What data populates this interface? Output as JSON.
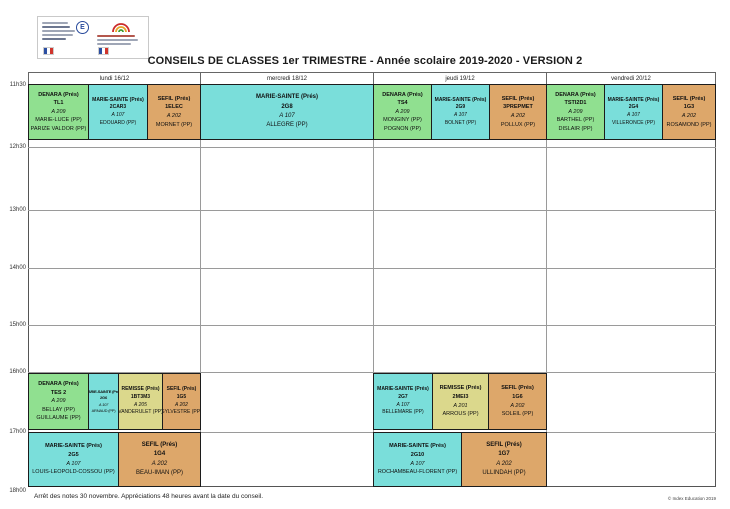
{
  "header": {
    "title": "CONSEILS DE CLASSES 1er TRIMESTRE - Année scolaire 2019-2020 - VERSION 2",
    "logos": {
      "emblem_letter": "E",
      "ministry_logo": "ministry-logo",
      "school_logo": "school-crest-logo",
      "flag": "french-flag-icon"
    }
  },
  "days": [
    "lundi 16/12",
    "mercredi 18/12",
    "jeudi 19/12",
    "vendredi 20/12"
  ],
  "times": [
    "11h30",
    "12h30",
    "13h00",
    "14h00",
    "15h00",
    "16h00",
    "17h00",
    "18h00"
  ],
  "legend_colors": {
    "DENARA": "#90e090",
    "MARIE-SAINTE": "#7adeda",
    "SEFIL": "#dda76a",
    "REMISSE": "#dbd88c"
  },
  "cells": [
    {
      "pres": "DENARA (Prés)",
      "cls": "TL1",
      "room": "A 209",
      "pps": [
        "MARIE-LUCE (PP)",
        "PARIZE VALDOR (PP)"
      ]
    },
    {
      "pres": "MARIE-SAINTE (Prés)",
      "cls": "2CAR3",
      "room": "A 107",
      "pps": [
        "EDOUARD (PP)"
      ]
    },
    {
      "pres": "SEFIL (Prés)",
      "cls": "1ELEC",
      "room": "A 202",
      "pps": [
        "MORNET (PP)"
      ]
    },
    {
      "pres": "MARIE-SAINTE (Prés)",
      "cls": "2G8",
      "room": "A 107",
      "pps": [
        "ALLEGRE (PP)"
      ]
    },
    {
      "pres": "DENARA (Prés)",
      "cls": "TS4",
      "room": "A 209",
      "pps": [
        "MONGINY (PP)",
        "POGNON (PP)"
      ]
    },
    {
      "pres": "MARIE-SAINTE (Prés)",
      "cls": "2G9",
      "room": "A 107",
      "pps": [
        "BOLNET (PP)"
      ]
    },
    {
      "pres": "SEFIL (Prés)",
      "cls": "3PREPMET",
      "room": "A 202",
      "pps": [
        "POLLUX (PP)"
      ]
    },
    {
      "pres": "DENARA (Prés)",
      "cls": "TSTI2D1",
      "room": "A 209",
      "pps": [
        "BARTHEL (PP)",
        "DISLAIR (PP)"
      ]
    },
    {
      "pres": "MARIE-SAINTE (Prés)",
      "cls": "2G4",
      "room": "A 107",
      "pps": [
        "VILLERONCE (PP)"
      ]
    },
    {
      "pres": "SEFIL (Prés)",
      "cls": "1G3",
      "room": "A 202",
      "pps": [
        "ROSAMOND (PP)"
      ]
    },
    {
      "pres": "DENARA (Prés)",
      "cls": "TES 2",
      "room": "A 209",
      "pps": [
        "BELLAY (PP)",
        "GUILLAUME (PP)"
      ]
    },
    {
      "pres": "MARIE-SAINTE (Prés)",
      "cls": "2G6",
      "room": "A 107",
      "pps": [
        "ARNAUD (PP)"
      ]
    },
    {
      "pres": "REMISSE (Prés)",
      "cls": "1BT3M3",
      "room": "A 205",
      "pps": [
        "VANDERULET (PP)"
      ]
    },
    {
      "pres": "SEFIL (Prés)",
      "cls": "1G5",
      "room": "A 202",
      "pps": [
        "SYLVESTRE (PP)"
      ]
    },
    {
      "pres": "MARIE-SAINTE (Prés)",
      "cls": "2G5",
      "room": "A 107",
      "pps": [
        "LOUIS-LEOPOLD-COSSOU (PP)"
      ]
    },
    {
      "pres": "SEFIL (Prés)",
      "cls": "1G4",
      "room": "A 202",
      "pps": [
        "BEAU-IMAN (PP)"
      ]
    },
    {
      "pres": "MARIE-SAINTE (Prés)",
      "cls": "2G7",
      "room": "A 107",
      "pps": [
        "BELLEMARE (PP)"
      ]
    },
    {
      "pres": "REMISSE (Prés)",
      "cls": "2MEI3",
      "room": "A 201",
      "pps": [
        "ARROUS (PP)"
      ]
    },
    {
      "pres": "SEFIL (Prés)",
      "cls": "1G6",
      "room": "A 202",
      "pps": [
        "SOLEIL (PP)"
      ]
    },
    {
      "pres": "MARIE-SAINTE (Prés)",
      "cls": "2G10",
      "room": "A 107",
      "pps": [
        "ROCHAMBEAU-FLORENT (PP)"
      ]
    },
    {
      "pres": "SEFIL (Prés)",
      "cls": "1G7",
      "room": "A 202",
      "pps": [
        "ULLINDAH (PP)"
      ]
    }
  ],
  "footer": {
    "note": "Arrêt des notes 30 novembre. Appréciations 48 heures avant la date du conseil.",
    "credit": "© Index Education 2019"
  }
}
